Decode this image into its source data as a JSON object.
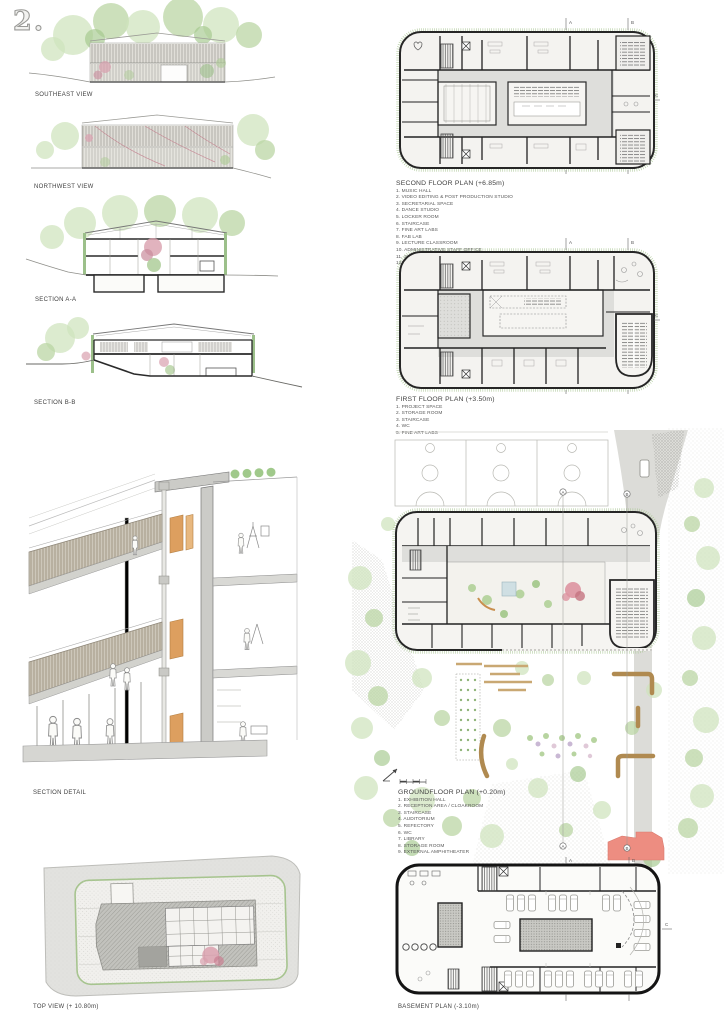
{
  "board": {
    "page_number": "2.",
    "palette": {
      "vegetation": "#b9d3a2",
      "vegetation_dark": "#93bb7c",
      "blossom_pink": "#d9a0ae",
      "door_orange": "#dd9f5f",
      "bench_wood": "#b08a50",
      "amphitheater_red": "#ec8b80",
      "plan_wall": "#1f1f1f",
      "corridor_gray": "#dcdcd8"
    }
  },
  "views": {
    "southeast": {
      "label": "SOUTHEAST VIEW"
    },
    "northwest": {
      "label": "NORTHWEST VIEW"
    },
    "section_aa": {
      "label": "SECTION A-A"
    },
    "section_bb": {
      "label": "SECTION B-B"
    },
    "section_detail": {
      "label": "SECTION DETAIL"
    },
    "top_view": {
      "label": "TOP VIEW (+ 10.80m)"
    }
  },
  "plans": {
    "second_floor": {
      "title": "SECOND FLOOR PLAN (+6.85m)",
      "legend": [
        "1. MUSIC HALL",
        "2. VIDEO EDITING & POST PRODUCTION STUDIO",
        "3. SECRETARIAL SPACE",
        "4. DANCE STUDIO",
        "5. LOCKER ROOM",
        "6. STAIRCASE",
        "7. FINE ART LABS",
        "8. FAB LAB",
        "9. LECTURE CLASSROOM",
        "10. ADMINISTRATIVE STAFF OFFICE",
        "11. STORAGE ROOM",
        "12. WC"
      ]
    },
    "first_floor": {
      "title": "FIRST FLOOR PLAN (+3.50m)",
      "legend": [
        "1. PROJECT SPACE",
        "2. STORAGE ROOM",
        "3. STAIRCASE",
        "4. WC",
        "5. FINE ART LABS"
      ]
    },
    "ground_floor": {
      "title": "GROUNDFLOOR PLAN (+0.20m)",
      "legend": [
        "1. EXHIBITION HALL",
        "2. RECEPTION AREA / CLOAKROOM",
        "3. STAIRCASE",
        "4. AUDITORIUM",
        "5. REFECTORY",
        "6. WC",
        "7. LIBRARY",
        "8. STORAGE ROOM",
        "9. EXTERNAL AMPHITHEATER"
      ]
    },
    "basement": {
      "title": "BASEMENT PLAN (-3.10m)"
    }
  },
  "markers": {
    "a": "A",
    "b": "B",
    "c": "C"
  }
}
